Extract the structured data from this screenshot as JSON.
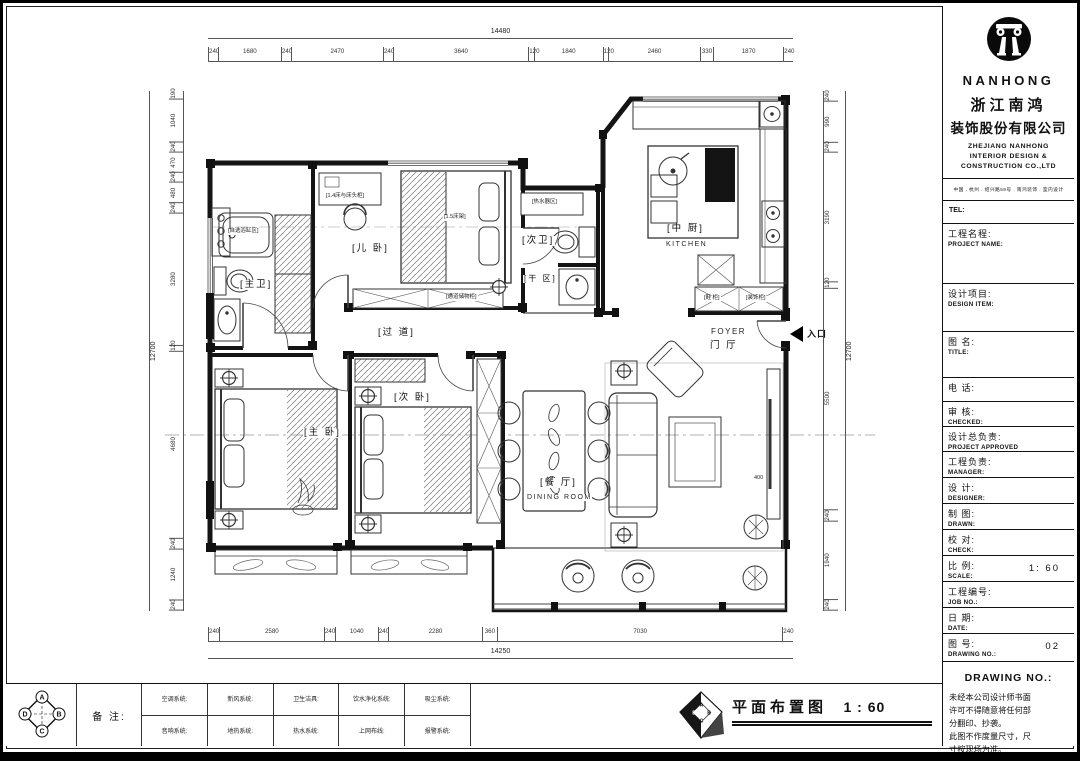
{
  "plan": {
    "rooms": {
      "master_bath": "[主卫]",
      "kids_room": "[儿 卧]",
      "second_bath": "[次卫]",
      "dry_area": "[干 区]",
      "kitchen": "[中 厨]",
      "kitchen_en": "KITCHEN",
      "corridor": "[过 道]",
      "second_bedroom": "[次 卧]",
      "master_bedroom": "[主 卧]",
      "dining": "[餐 厅]",
      "dining_en": "DINING ROOM",
      "foyer_en": "FOYER",
      "foyer": "门 厅"
    },
    "entrance": "入口",
    "annotations": {
      "bathtub": "[自选浴缸区]",
      "kids_closet": "[1.4床与床头柜]",
      "kids_bed": "[1.5床架]",
      "heater": "[热水器区]",
      "corridor_storage": "[通道储物柜]",
      "shoe_cabinet": "[鞋 柜]",
      "deco_cabinet": "[装饰柜]",
      "dim_400": "400"
    },
    "dims": {
      "top": {
        "overall": "14480",
        "segments": [
          240,
          1680,
          240,
          2470,
          240,
          3640,
          120,
          1840,
          120,
          2460,
          330,
          1870,
          240
        ]
      },
      "bottom": {
        "overall": "14250",
        "segments": [
          240,
          2580,
          240,
          1040,
          240,
          2280,
          360,
          7030,
          240
        ]
      },
      "left": {
        "overall": "12700",
        "segments": [
          190,
          1040,
          240,
          470,
          240,
          480,
          240,
          3280,
          120,
          4680,
          240,
          1240,
          240
        ]
      },
      "right": {
        "overall": "12700",
        "segments": [
          240,
          990,
          240,
          3190,
          120,
          5500,
          240,
          1940,
          240
        ]
      }
    }
  },
  "footer": {
    "remark_label": "备 注:",
    "systems_row1": [
      "空调系统:",
      "新风系统:",
      "卫生洁具:",
      "饮水净化系统:",
      "吸尘系统:"
    ],
    "systems_row2": [
      "音响系统:",
      "地热系统:",
      "热水系统:",
      "上网布线:",
      "报警系统:"
    ],
    "drawing_title": "平面布置图",
    "drawing_scale": "1 : 60",
    "compass": {
      "a": "A",
      "b": "B",
      "c": "C",
      "d": "D"
    }
  },
  "title_block": {
    "brand_en": "NANHONG",
    "brand_cn_line1": "浙江南鸿",
    "brand_cn_line2": "装饰股份有限公司",
    "company_en_line1": "ZHEJIANG NANHONG",
    "company_en_line2": "INTERIOR DESIGN &",
    "company_en_line3": "CONSTRUCTION CO.,LTD",
    "address": "中国 . 杭州 . 绍兴路59号 . 南鸿装饰 . 室内设计",
    "tel_label": "TEL:",
    "fields": [
      {
        "cn": "工程名程:",
        "en": "PROJECT NAME:",
        "value": ""
      },
      {
        "cn": "设计项目:",
        "en": "DESIGN ITEM:",
        "value": ""
      },
      {
        "cn": "图  名:",
        "en": "TITLE:",
        "value": ""
      },
      {
        "cn": "电    话:",
        "en": "",
        "value": ""
      },
      {
        "cn": "审    核:",
        "en": "CHECKED:",
        "value": ""
      },
      {
        "cn": "设计总负责:",
        "en": "PROJECT APPROVED",
        "value": ""
      },
      {
        "cn": "工程负责:",
        "en": "MANAGER:",
        "value": ""
      },
      {
        "cn": "设  计:",
        "en": "DESIGNER:",
        "value": ""
      },
      {
        "cn": "制  图:",
        "en": "DRAWN:",
        "value": ""
      },
      {
        "cn": "校  对:",
        "en": "CHECK:",
        "value": ""
      },
      {
        "cn": "比  例:",
        "en": "SCALE:",
        "value": "1: 60"
      },
      {
        "cn": "工程编号:",
        "en": "JOB NO.:",
        "value": ""
      },
      {
        "cn": "日  期:",
        "en": "DATE:",
        "value": ""
      },
      {
        "cn": "图  号:",
        "en": "DRAWING NO.:",
        "value": "02"
      }
    ],
    "notes_heading": "DRAWING NO.:",
    "notes_lines": [
      "未经本公司设计师书面",
      "许可不得随意将任何部",
      "分翻印、抄袭。",
      "此图不作度量尺寸，尺",
      "寸按现场为准。",
      "若有不明之处，应立即",
      "通知设计师。"
    ]
  }
}
